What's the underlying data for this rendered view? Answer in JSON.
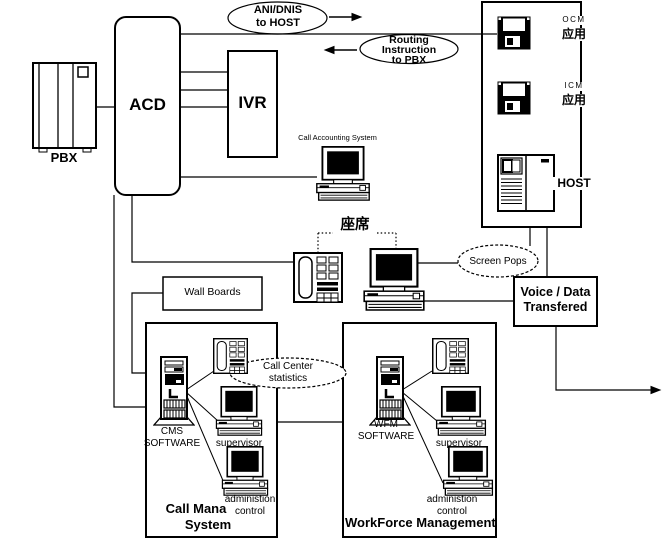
{
  "diagram": {
    "pbx_label": "PBX",
    "acd_label": "ACD",
    "ivr_label": "IVR",
    "ani_ellipse": {
      "line1": "ANI/DNIS",
      "line2": "to HOST"
    },
    "routing_ellipse": {
      "line1": "Routing",
      "line2": "Instruction",
      "line3": "to PBX"
    },
    "host_panel": {
      "ocm_label": "OCM",
      "ocm_app": "应用",
      "icm_label": "ICM",
      "icm_app": "应用",
      "host_label": "HOST"
    },
    "call_accounting_label": "Call Accounting System",
    "agent_seat_label": "座席",
    "wall_boards_label": "Wall Boards",
    "screen_pops_label": "Screen Pops",
    "voice_data": {
      "line1": "Voice / Data",
      "line2": "Transfered"
    },
    "call_center_stats": {
      "line1": "Call  Center",
      "line2": "statistics"
    },
    "cms_box": {
      "software_line1": "CMS",
      "software_line2": "SOFTWARE",
      "supervisor_label": "supervisor",
      "admin_line1": "administion",
      "admin_line2": "control",
      "title_line1": "Call Mana",
      "title_line2": "System"
    },
    "wfm_box": {
      "software_line1": "WFM",
      "software_line2": "SOFTWARE",
      "supervisor_label": "supervisor",
      "admin_line1": "administion",
      "admin_line2": "control",
      "title": "WorkForce Management"
    }
  }
}
